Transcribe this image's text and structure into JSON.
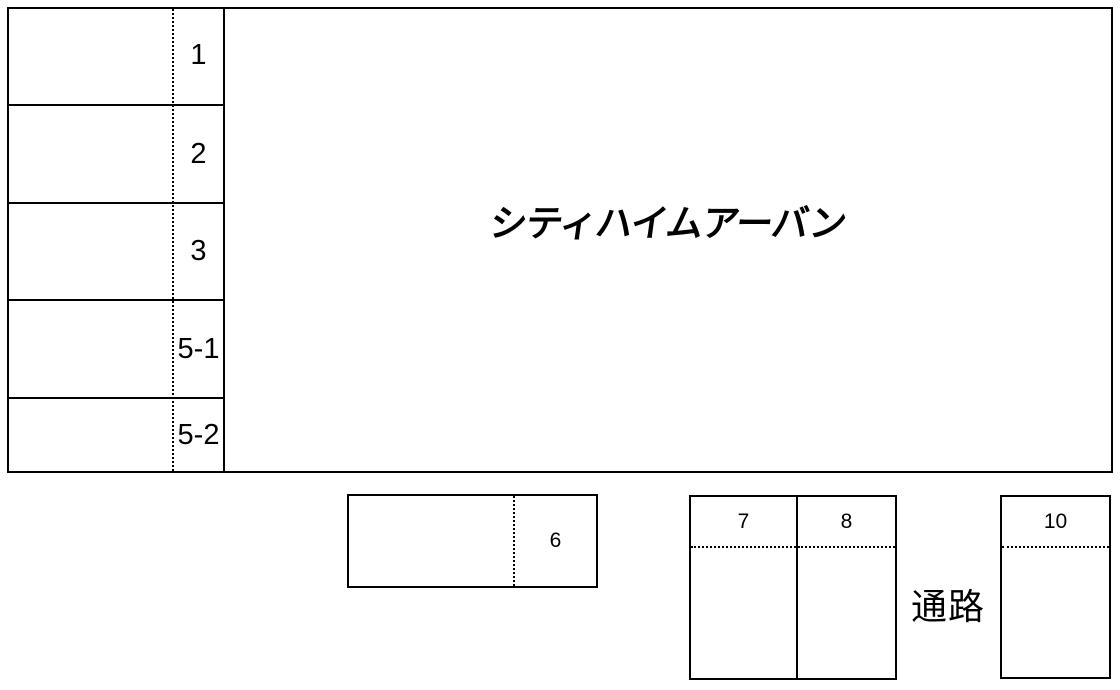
{
  "parking": {
    "building_name": "シティハイムアーバン",
    "aisle_label": "通路",
    "left_spaces": [
      "1",
      "2",
      "3",
      "5-1",
      "5-2"
    ],
    "middle_space": "6",
    "bottom_spaces": [
      "7",
      "8"
    ],
    "right_space": "10",
    "line_color": "#000000",
    "background_color": "#ffffff"
  }
}
